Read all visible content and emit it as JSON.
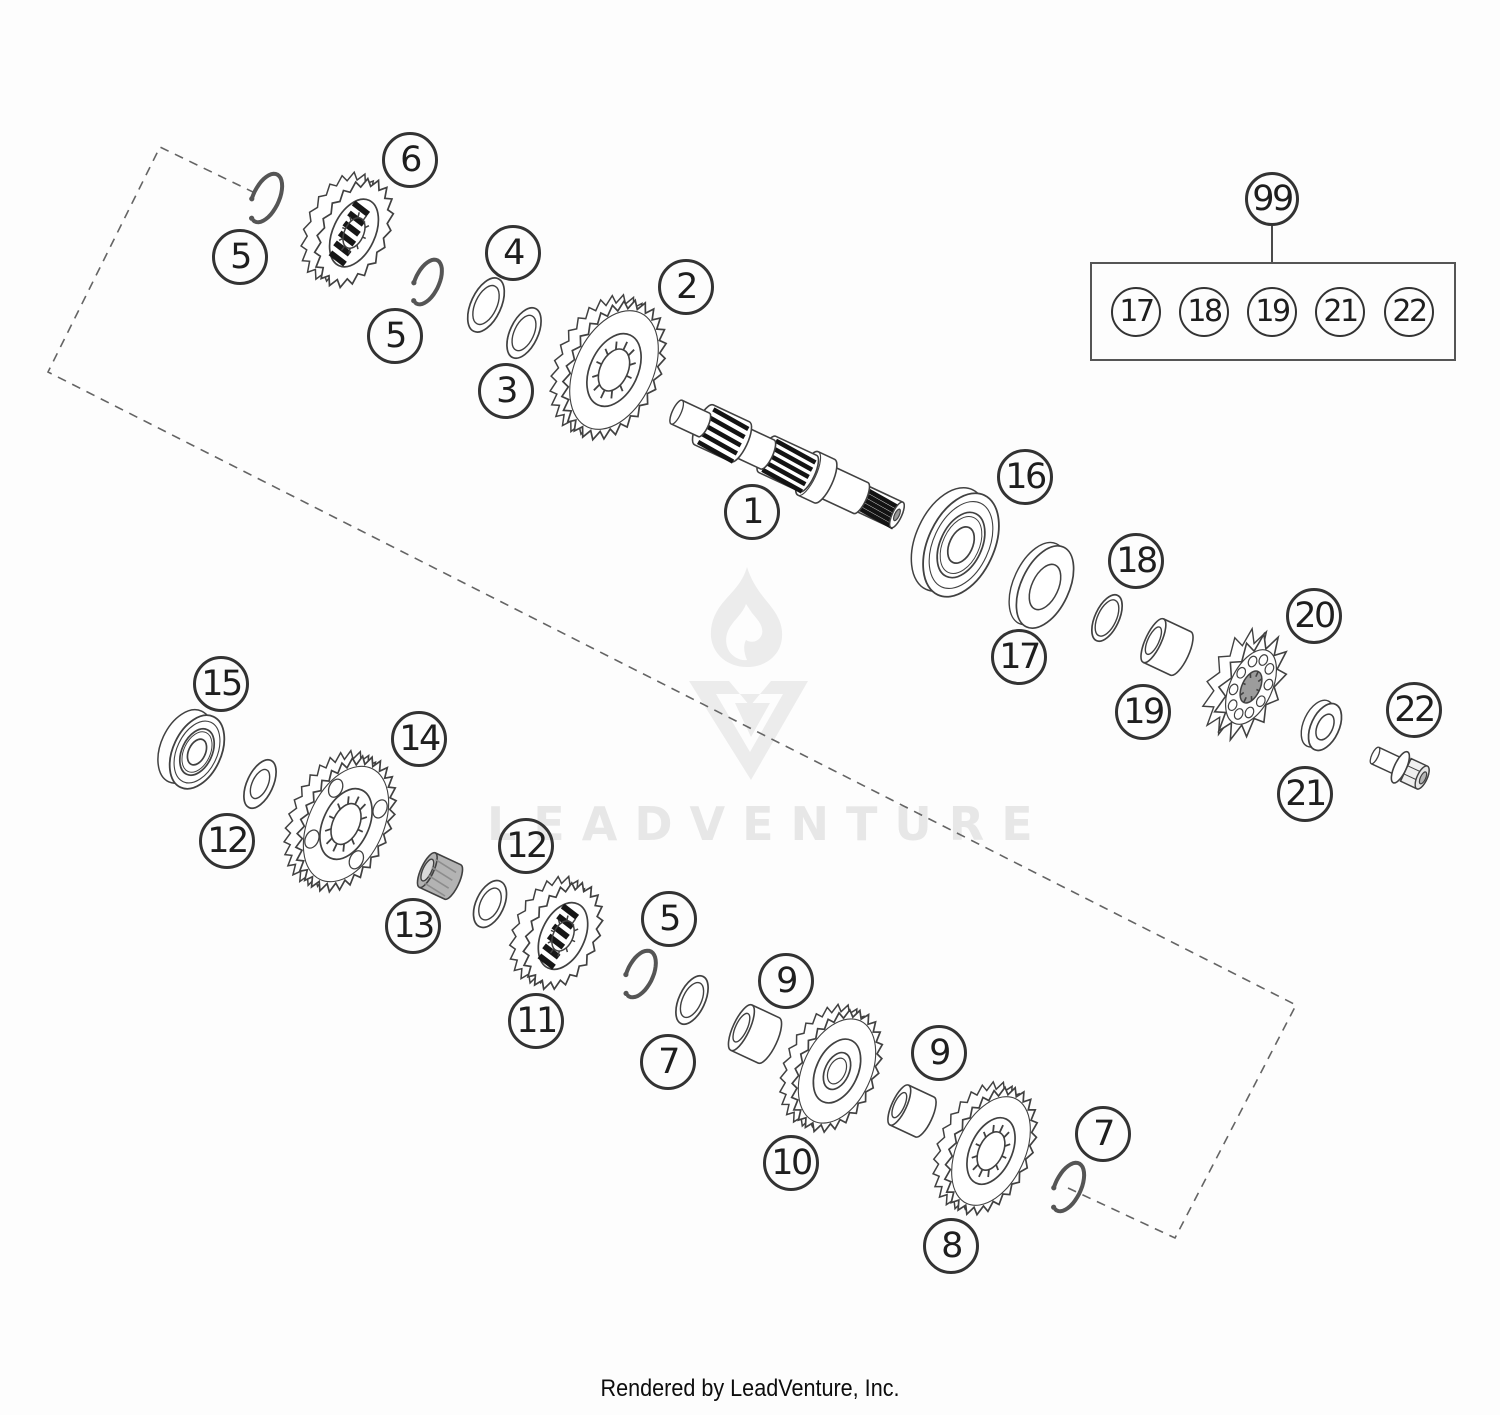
{
  "page": {
    "background": "#fdfdfd",
    "caption": "Rendered by LeadVenture, Inc."
  },
  "watermark": {
    "text": "LEADVENTURE",
    "color": "#e7e7e7",
    "flame_icon": "leadventure-flame-icon",
    "monogram_icon": "leadventure-v-monogram-icon"
  },
  "diagram": {
    "tilt_deg": 25,
    "line_color": "#414141",
    "callout_radius": 28,
    "outline": {
      "color": "#646464",
      "dash": [
        9,
        7
      ],
      "points": [
        [
          255,
          193
        ],
        [
          160,
          147
        ],
        [
          48,
          372
        ],
        [
          1296,
          1005
        ],
        [
          1175,
          1238
        ],
        [
          1068,
          1188
        ]
      ]
    },
    "callouts": [
      {
        "label": "6",
        "x": 410,
        "y": 160
      },
      {
        "label": "5",
        "x": 240,
        "y": 257
      },
      {
        "label": "5",
        "x": 395,
        "y": 336
      },
      {
        "label": "4",
        "x": 513,
        "y": 253
      },
      {
        "label": "3",
        "x": 506,
        "y": 391
      },
      {
        "label": "2",
        "x": 686,
        "y": 287
      },
      {
        "label": "1",
        "x": 752,
        "y": 512
      },
      {
        "label": "16",
        "x": 1025,
        "y": 477
      },
      {
        "label": "18",
        "x": 1136,
        "y": 561
      },
      {
        "label": "17",
        "x": 1019,
        "y": 657
      },
      {
        "label": "19",
        "x": 1143,
        "y": 712
      },
      {
        "label": "20",
        "x": 1314,
        "y": 616
      },
      {
        "label": "22",
        "x": 1414,
        "y": 710
      },
      {
        "label": "21",
        "x": 1305,
        "y": 794
      },
      {
        "label": "15",
        "x": 221,
        "y": 684
      },
      {
        "label": "12",
        "x": 227,
        "y": 841
      },
      {
        "label": "14",
        "x": 419,
        "y": 739
      },
      {
        "label": "13",
        "x": 413,
        "y": 926
      },
      {
        "label": "12",
        "x": 526,
        "y": 846
      },
      {
        "label": "11",
        "x": 536,
        "y": 1021
      },
      {
        "label": "5",
        "x": 669,
        "y": 919
      },
      {
        "label": "7",
        "x": 668,
        "y": 1062
      },
      {
        "label": "9",
        "x": 786,
        "y": 981
      },
      {
        "label": "10",
        "x": 791,
        "y": 1163
      },
      {
        "label": "9",
        "x": 939,
        "y": 1053
      },
      {
        "label": "8",
        "x": 951,
        "y": 1246
      },
      {
        "label": "7",
        "x": 1103,
        "y": 1134
      }
    ],
    "group99": {
      "label": "99",
      "x": 1272,
      "y": 199,
      "r": 27,
      "box": {
        "x": 1090,
        "y": 262,
        "w": 366,
        "h": 99
      },
      "item_radius": 25,
      "items": [
        {
          "label": "17",
          "x": 1136,
          "y": 312
        },
        {
          "label": "18",
          "x": 1204,
          "y": 312
        },
        {
          "label": "19",
          "x": 1272,
          "y": 312
        },
        {
          "label": "21",
          "x": 1340,
          "y": 312
        },
        {
          "label": "22",
          "x": 1409,
          "y": 312
        }
      ]
    },
    "parts": [
      {
        "name": "flange-bolt-22",
        "type": "bolt",
        "cx": 1404,
        "cy": 769
      },
      {
        "name": "washer-21",
        "type": "ring3d",
        "cx": 1325,
        "cy": 727,
        "rx": 14,
        "ry": 25
      },
      {
        "name": "chain-sprocket-20",
        "type": "sprocket",
        "cx": 1251,
        "cy": 687,
        "rx": 30,
        "ry": 57,
        "teeth": 13
      },
      {
        "name": "bushing-19",
        "type": "cylinder",
        "cx": 1167,
        "cy": 647,
        "r": 24,
        "len": 30
      },
      {
        "name": "oring-18",
        "type": "ring",
        "cx": 1107,
        "cy": 618,
        "rx": 12,
        "ry": 25,
        "inner": 0.78
      },
      {
        "name": "spacer-17",
        "type": "ring3d",
        "cx": 1045,
        "cy": 587,
        "rx": 24,
        "ry": 44
      },
      {
        "name": "ball-bearing-16",
        "type": "bearing",
        "cx": 961,
        "cy": 545,
        "rx": 33,
        "ry": 55
      },
      {
        "name": "mainshaft-1",
        "type": "shaft",
        "cx": 790,
        "cy": 465,
        "segments": [
          {
            "x0": -125,
            "x1": -95,
            "r": 13,
            "style": "plain"
          },
          {
            "x0": -95,
            "x1": -55,
            "r": 22,
            "style": "spline"
          },
          {
            "x0": -55,
            "x1": -25,
            "r": 16,
            "style": "plain"
          },
          {
            "x0": -25,
            "x1": 20,
            "r": 20,
            "style": "spline"
          },
          {
            "x0": 20,
            "x1": 38,
            "r": 24,
            "style": "collar"
          },
          {
            "x0": 38,
            "x1": 78,
            "r": 17,
            "style": "plain"
          },
          {
            "x0": 78,
            "x1": 118,
            "r": 14,
            "style": "spline_tip"
          }
        ]
      },
      {
        "name": "gear-2",
        "type": "gear",
        "cx": 614,
        "cy": 370,
        "rx": 46,
        "ry": 74,
        "teeth": 28,
        "splined": true
      },
      {
        "name": "washer-3",
        "type": "ring",
        "cx": 524,
        "cy": 333,
        "rx": 14,
        "ry": 27,
        "inner": 0.7
      },
      {
        "name": "washer-4",
        "type": "ring",
        "cx": 486,
        "cy": 305,
        "rx": 15,
        "ry": 29,
        "inner": 0.72
      },
      {
        "name": "circlip-5-mid",
        "type": "circlip",
        "cx": 427,
        "cy": 282,
        "rx": 12,
        "ry": 24
      },
      {
        "name": "dog-gear-6",
        "type": "dog_gear",
        "cx": 354,
        "cy": 233,
        "rx": 34,
        "ry": 58,
        "teeth": 20
      },
      {
        "name": "circlip-5-top",
        "type": "circlip",
        "cx": 266,
        "cy": 198,
        "rx": 13,
        "ry": 26
      },
      {
        "name": "circlip-7-bottom",
        "type": "circlip",
        "cx": 1068,
        "cy": 1187,
        "rx": 13,
        "ry": 26
      },
      {
        "name": "gear-8",
        "type": "gear",
        "cx": 991,
        "cy": 1151,
        "rx": 40,
        "ry": 68,
        "teeth": 26,
        "splined": true
      },
      {
        "name": "bushing-9b",
        "type": "cylinder",
        "cx": 912,
        "cy": 1111,
        "r": 22,
        "len": 28
      },
      {
        "name": "gear-10",
        "type": "gear",
        "cx": 837,
        "cy": 1071,
        "rx": 40,
        "ry": 65,
        "teeth": 26,
        "splined": false
      },
      {
        "name": "bushing-9a",
        "type": "cylinder",
        "cx": 755,
        "cy": 1034,
        "r": 25,
        "len": 30
      },
      {
        "name": "washer-7a",
        "type": "ring",
        "cx": 692,
        "cy": 1000,
        "rx": 13,
        "ry": 26,
        "inner": 0.72
      },
      {
        "name": "circlip-5c",
        "type": "circlip",
        "cx": 640,
        "cy": 974,
        "rx": 13,
        "ry": 25
      },
      {
        "name": "dog-gear-11",
        "type": "dog_gear",
        "cx": 563,
        "cy": 936,
        "rx": 35,
        "ry": 57,
        "teeth": 22
      },
      {
        "name": "washer-12b",
        "type": "ring",
        "cx": 490,
        "cy": 904,
        "rx": 14,
        "ry": 25,
        "inner": 0.68
      },
      {
        "name": "bushing-13",
        "type": "cylinder",
        "cx": 440,
        "cy": 876,
        "r": 19,
        "len": 28,
        "dark": true
      },
      {
        "name": "gear-14",
        "type": "gear",
        "cx": 346,
        "cy": 824,
        "rx": 44,
        "ry": 72,
        "teeth": 30,
        "splined": true,
        "holes": true
      },
      {
        "name": "washer-12a",
        "type": "ring",
        "cx": 260,
        "cy": 784,
        "rx": 13,
        "ry": 26,
        "inner": 0.6
      },
      {
        "name": "ball-bearing-15",
        "type": "bearing",
        "cx": 197,
        "cy": 752,
        "rx": 24,
        "ry": 39
      }
    ]
  }
}
